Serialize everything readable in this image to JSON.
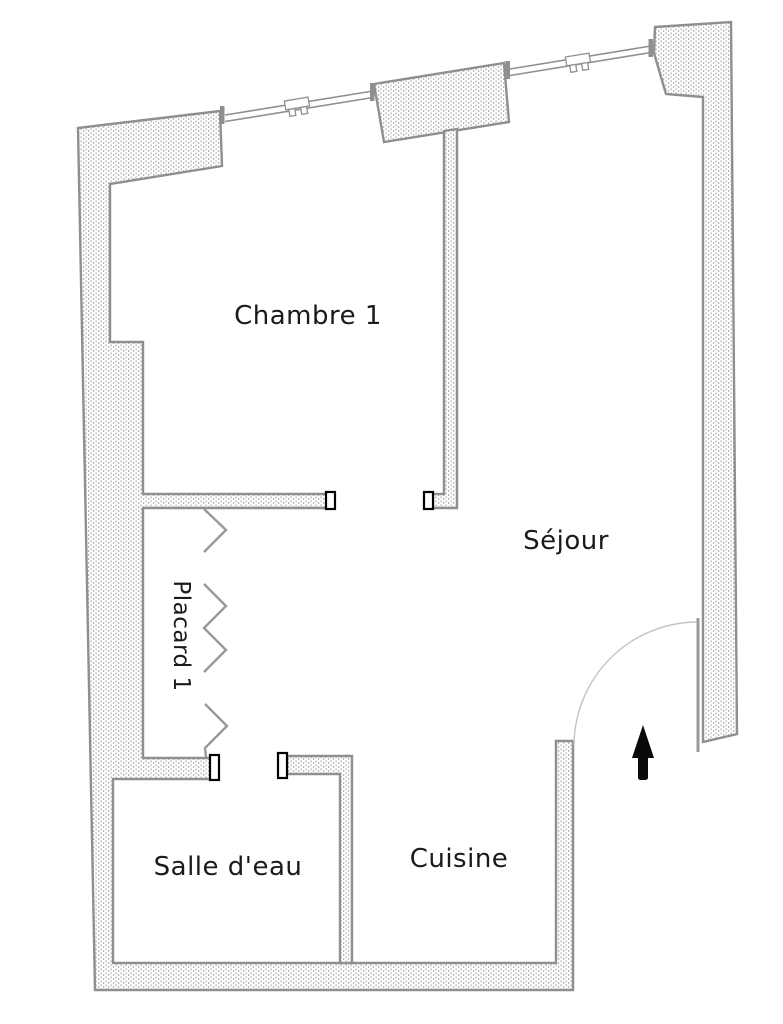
{
  "colors": {
    "background": "#ffffff",
    "wall_outline": "#8f8f8f",
    "wall_hatch_dot": "#b3b3b3",
    "window_line": "#8f8f8f",
    "door_arc": "#c4c4c4",
    "door_leaf": "#9a9a9a",
    "folding_door": "#999999",
    "jamb_outline": "#000000",
    "arrow": "#0a0a0a",
    "label_text": "#1a1a1a"
  },
  "rooms": {
    "chambre1": {
      "label": "Chambre 1"
    },
    "sejour": {
      "label": "Séjour"
    },
    "placard1": {
      "label": "Placard 1"
    },
    "salle_deau": {
      "label": "Salle d'eau"
    },
    "cuisine": {
      "label": "Cuisine"
    }
  },
  "symbols": {
    "entrance_arrow": "up-arrow-icon",
    "entry_door": "quarter-circle-door-swing",
    "placard_doors": "folding-door-zigzag",
    "windows_count": 2,
    "door_jambs_count": 4
  }
}
